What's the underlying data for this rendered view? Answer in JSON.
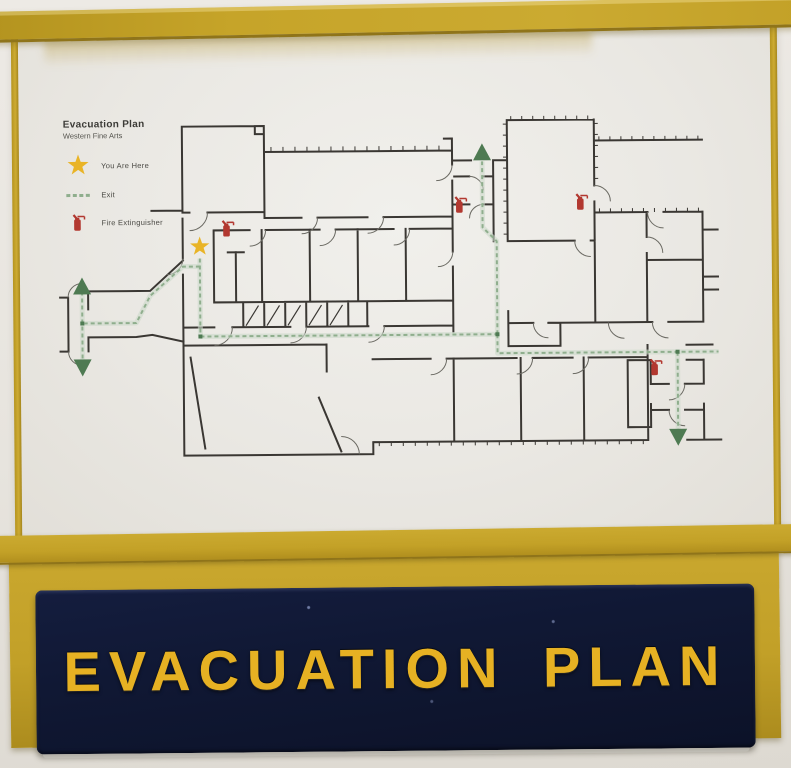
{
  "sign": {
    "label": "EVACUATION PLAN",
    "bg": "#101834",
    "text_color": "#e6b123"
  },
  "frame": {
    "color": "#c3a128"
  },
  "poster": {
    "title": "Evacuation Plan",
    "subtitle": "Western Fine Arts",
    "legend": [
      {
        "symbol": "star",
        "label": "You Are Here"
      },
      {
        "symbol": "route-dash",
        "label": "Exit"
      },
      {
        "symbol": "fire-extinguisher",
        "label": "Fire Extinguisher"
      }
    ]
  },
  "plan": {
    "colors": {
      "wall": "#3a3733",
      "route": "#8fae8d",
      "route_halo": "#ccd9c9",
      "arrow": "#4e7a52",
      "star": "#e9b427",
      "extinguisher": "#b23830"
    },
    "you_are_here": {
      "x": 200,
      "y": 246
    },
    "extinguishers": [
      {
        "x": 228,
        "y": 229
      },
      {
        "x": 461,
        "y": 207
      },
      {
        "x": 582,
        "y": 205
      },
      {
        "x": 655,
        "y": 371
      }
    ],
    "routes": [
      [
        [
          200,
          258
        ],
        [
          200,
          336
        ]
      ],
      [
        [
          200,
          336
        ],
        [
          497,
          336
        ]
      ],
      [
        [
          497,
          336
        ],
        [
          497,
          355
        ],
        [
          718,
          355
        ]
      ],
      [
        [
          497,
          336
        ],
        [
          497,
          243
        ],
        [
          483,
          229
        ],
        [
          483,
          163
        ]
      ],
      [
        [
          677,
          355
        ],
        [
          677,
          434
        ]
      ],
      [
        [
          200,
          266
        ],
        [
          183,
          266
        ],
        [
          150,
          295
        ],
        [
          136,
          322
        ],
        [
          84,
          322
        ]
      ],
      [
        [
          82,
          290
        ],
        [
          82,
          361
        ]
      ]
    ],
    "route_nodes": [
      [
        200,
        336
      ],
      [
        497,
        336
      ],
      [
        677,
        355
      ],
      [
        82,
        322
      ]
    ],
    "exit_arrows": [
      {
        "x": 483,
        "y": 156,
        "dir": "up"
      },
      {
        "x": 82,
        "y": 287,
        "dir": "up"
      },
      {
        "x": 82,
        "y": 364,
        "dir": "down"
      },
      {
        "x": 677,
        "y": 438,
        "dir": "down"
      }
    ]
  }
}
